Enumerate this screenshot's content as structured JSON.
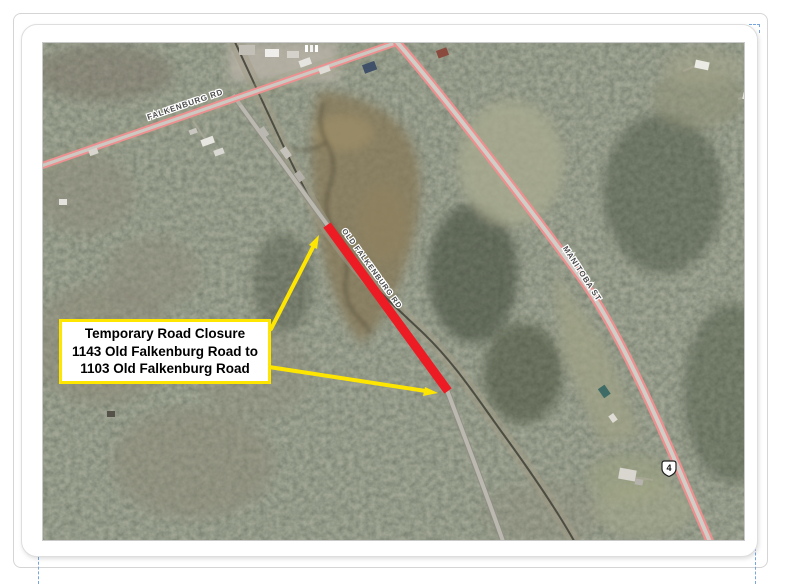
{
  "map": {
    "road_labels": [
      {
        "id": "falkenburg-rd",
        "text": "FALKENBURG RD"
      },
      {
        "id": "old-falkenburg-rd",
        "text": "OLD FALKENBURG RD"
      },
      {
        "id": "manitoba-st",
        "text": "MANITOBA ST"
      }
    ],
    "route_shield": {
      "number": "4"
    },
    "closure": {
      "line_color": "#ed1c24",
      "callout": {
        "line1": "Temporary Road Closure",
        "line2": "1143 Old Falkenburg Road to",
        "line3": "1103 Old Falkenburg Road",
        "border_color": "#ffe600",
        "arrow_color": "#ffe600",
        "text_color": "#000000",
        "background": "#ffffff"
      }
    }
  },
  "frame": {
    "card_background": "#ffffff",
    "border_color": "#d5d5d5",
    "dash_color": "#76a6dd"
  }
}
